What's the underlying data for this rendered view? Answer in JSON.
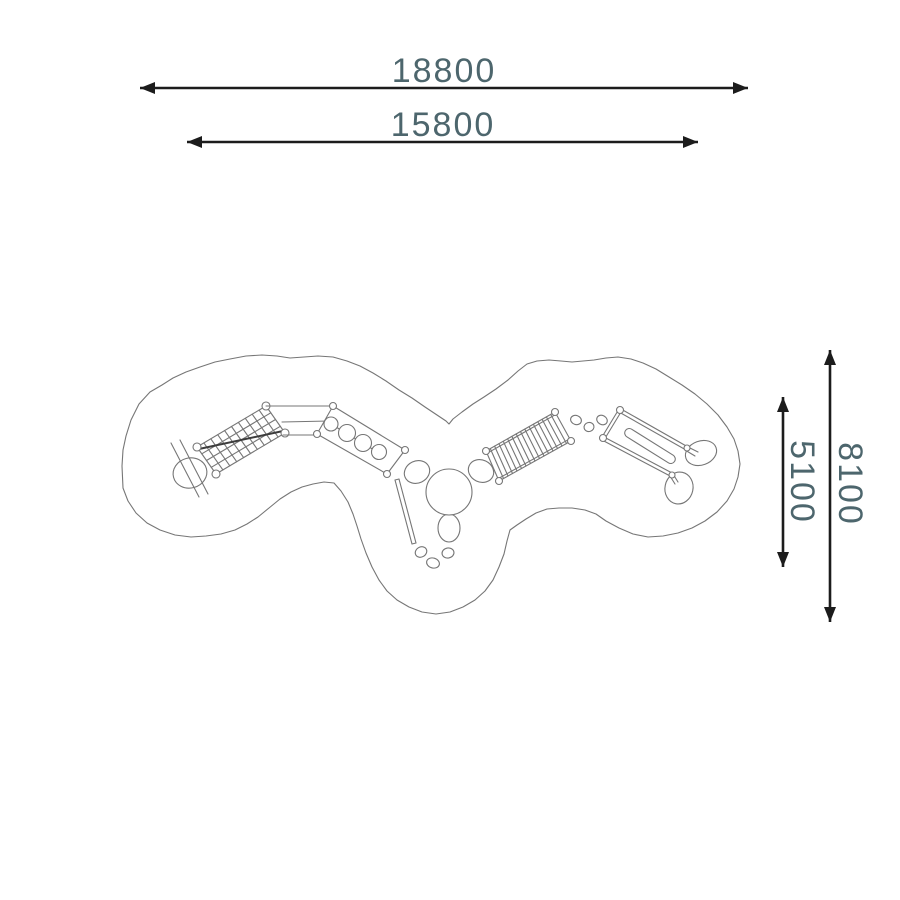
{
  "colors": {
    "background": "#ffffff",
    "dimension_line": "#1c1c1c",
    "dimension_text": "#4d666d",
    "drawing_line": "#767676"
  },
  "dimensions": {
    "horizontal": [
      {
        "label": "18800"
      },
      {
        "label": "15800"
      }
    ],
    "vertical": [
      {
        "label": "8100"
      },
      {
        "label": "5100"
      }
    ]
  }
}
